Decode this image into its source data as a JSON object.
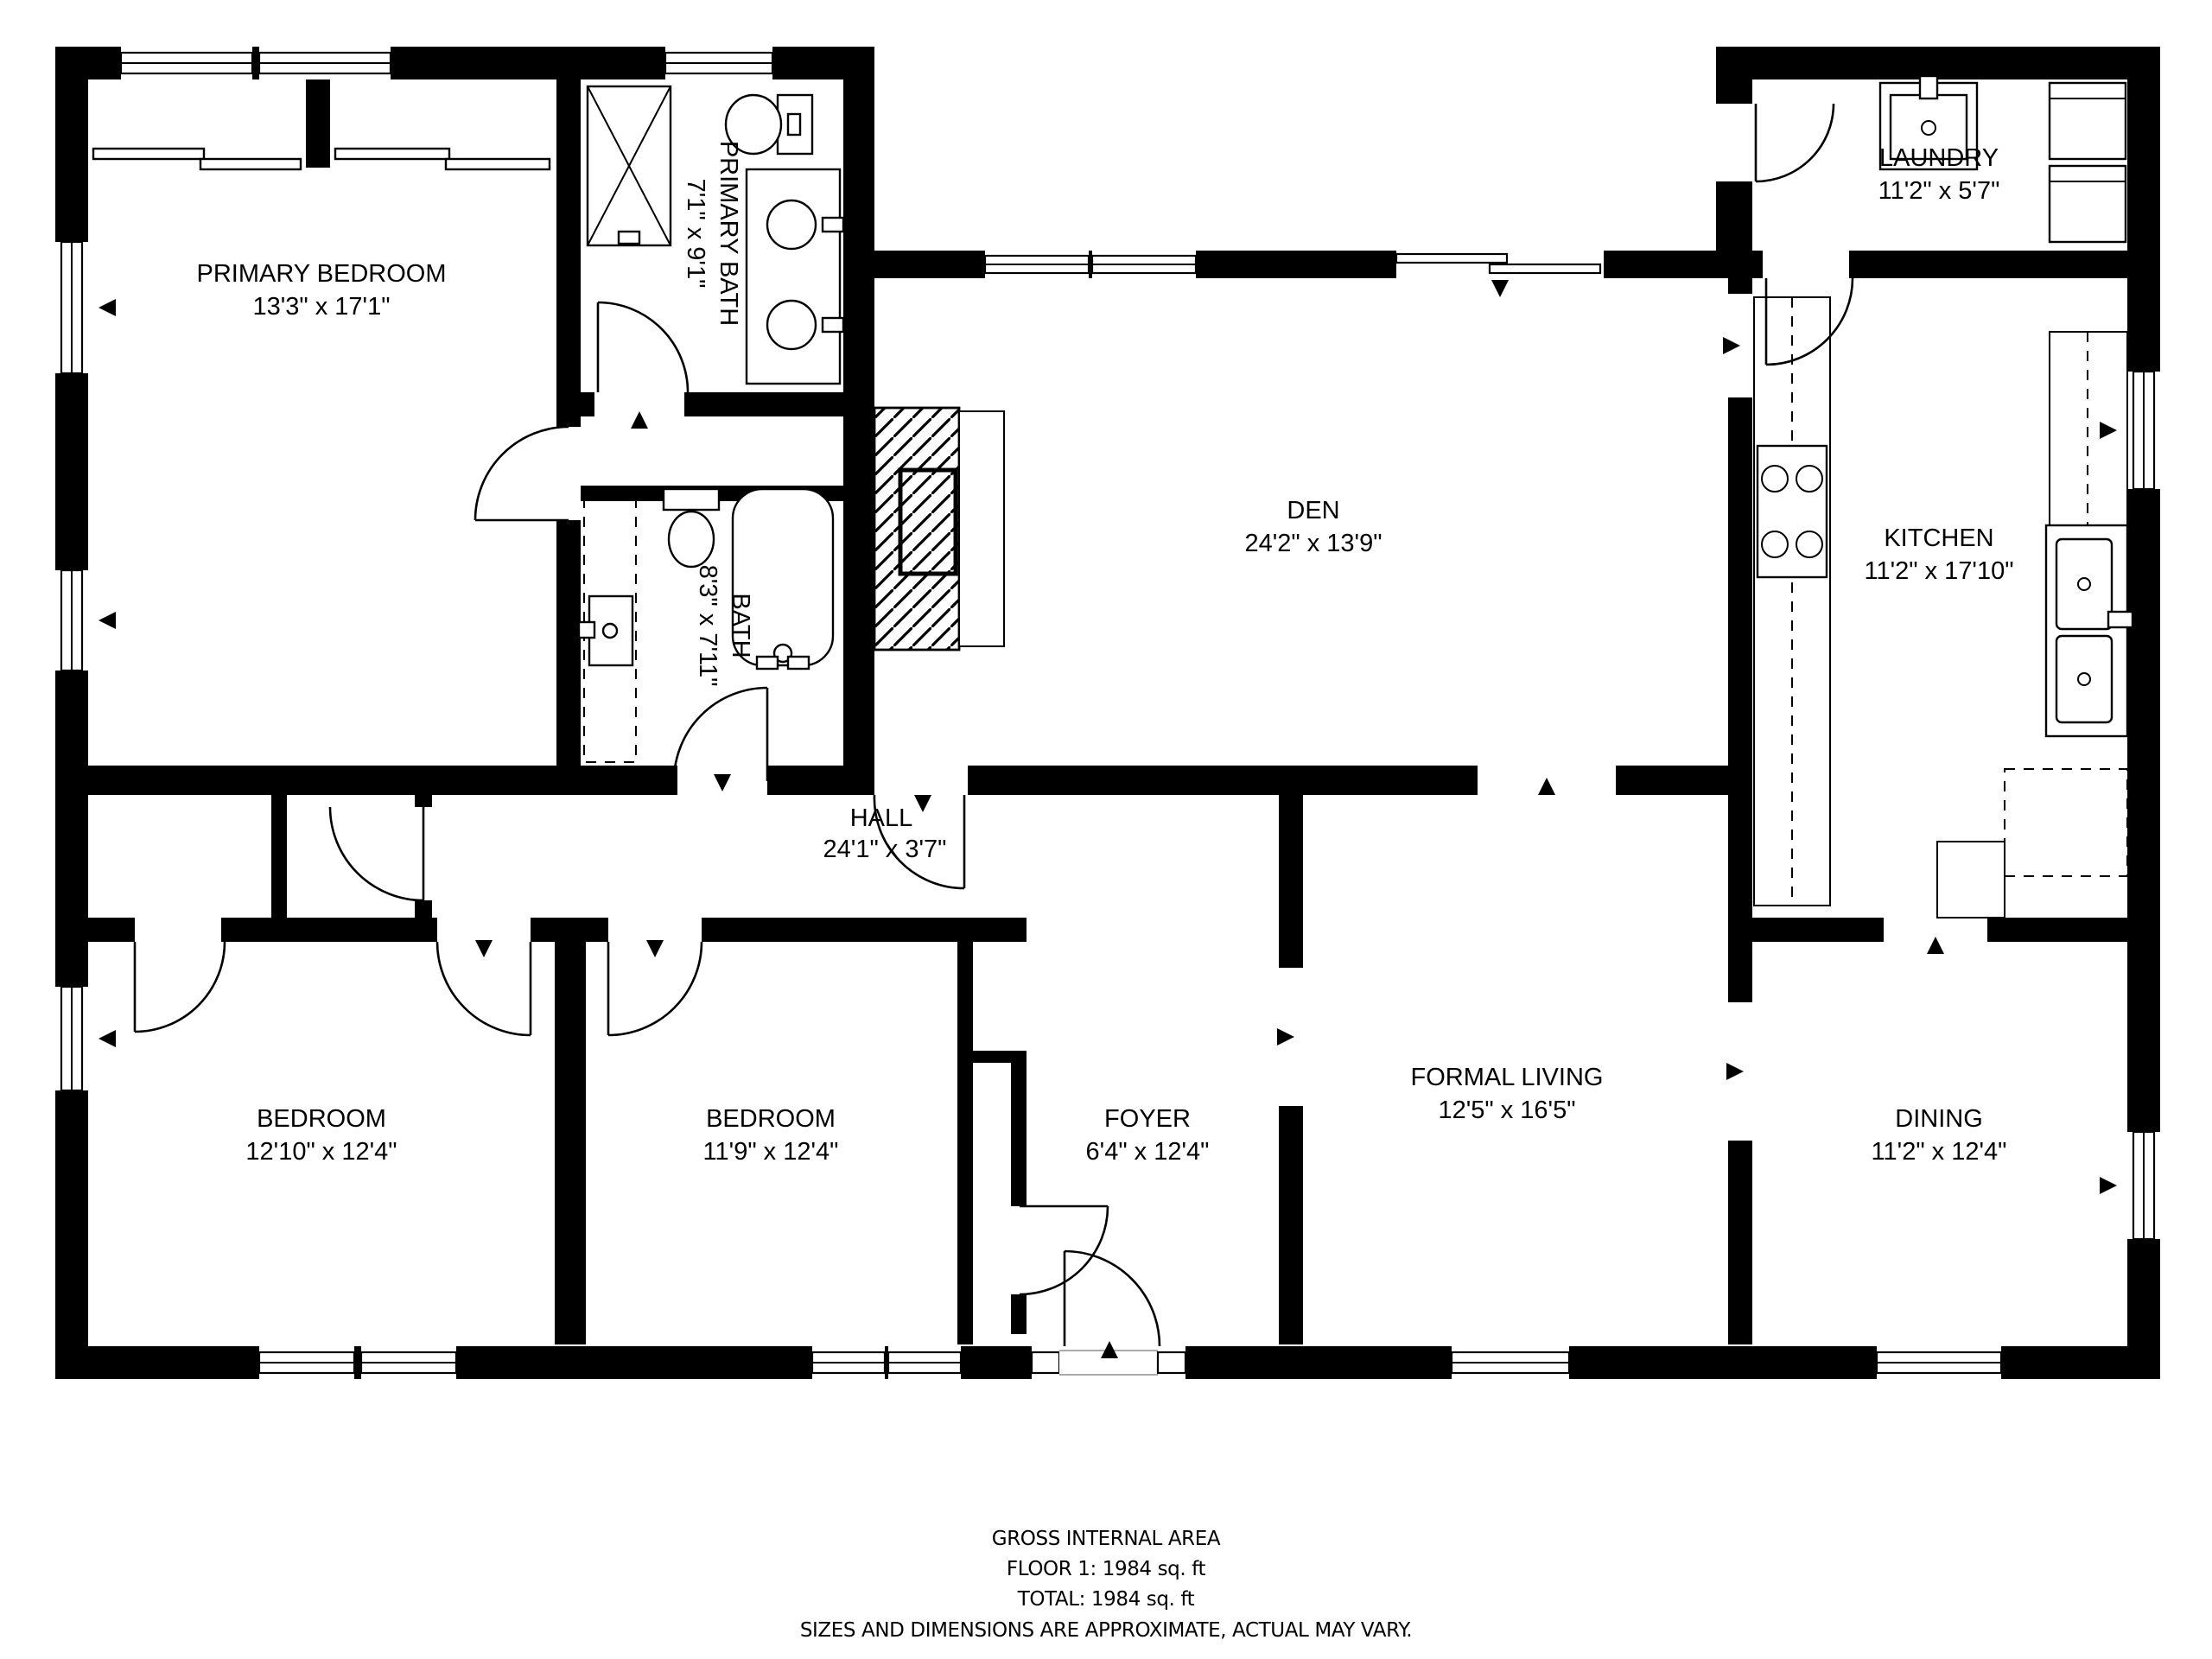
{
  "title": "Floor plan",
  "colors": {
    "wall": "#000000",
    "background": "#ffffff",
    "text": "#000000"
  },
  "rooms": {
    "primary_bedroom": {
      "name": "PRIMARY BEDROOM",
      "dims": "13'3\" x 17'1\""
    },
    "primary_bath": {
      "name": "PRIMARY BATH",
      "dims": "7'1\" x 9'1\""
    },
    "bath": {
      "name": "BATH",
      "dims": "8'3\" x 7'11\""
    },
    "den": {
      "name": "DEN",
      "dims": "24'2\" x 13'9\""
    },
    "laundry": {
      "name": "LAUNDRY",
      "dims": "11'2\" x 5'7\""
    },
    "kitchen": {
      "name": "KITCHEN",
      "dims": "11'2\" x 17'10\""
    },
    "hall": {
      "name": "HALL",
      "dims": "24'1\" x 3'7\""
    },
    "bedroom_left": {
      "name": "BEDROOM",
      "dims": "12'10\" x 12'4\""
    },
    "bedroom_middle": {
      "name": "BEDROOM",
      "dims": "11'9\" x 12'4\""
    },
    "foyer": {
      "name": "FOYER",
      "dims": "6'4\" x 12'4\""
    },
    "formal_living": {
      "name": "FORMAL LIVING",
      "dims": "12'5\" x 16'5\""
    },
    "dining": {
      "name": "DINING",
      "dims": "11'2\" x 12'4\""
    }
  },
  "footer": {
    "area_title": "GROSS INTERNAL AREA",
    "floor_line": "FLOOR 1: 1984 sq. ft",
    "total_line": "TOTAL: 1984 sq. ft",
    "disclaimer": "SIZES AND DIMENSIONS ARE APPROXIMATE, ACTUAL MAY VARY."
  }
}
